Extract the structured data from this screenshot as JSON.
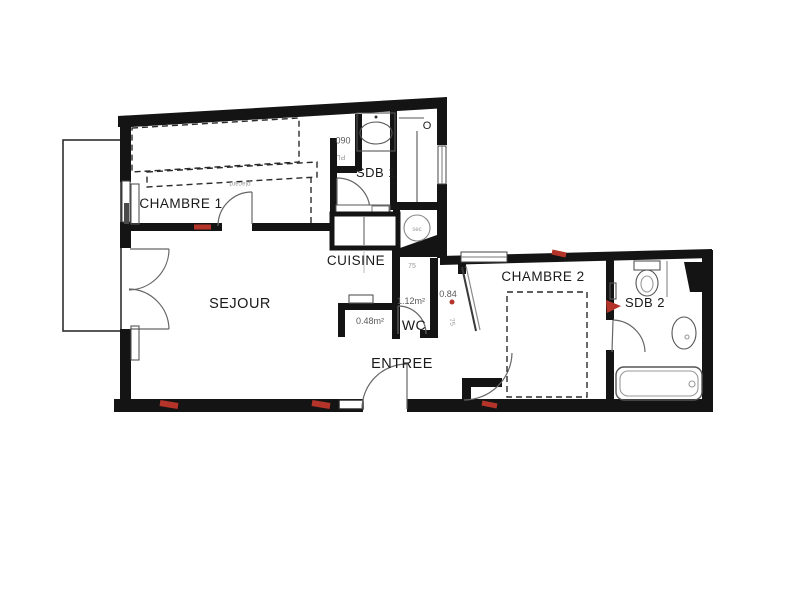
{
  "meta": {
    "type": "apartment-floor-plan"
  },
  "rooms": {
    "chambre1": "CHAMBRE 1",
    "sejour": "SEJOUR",
    "cuisine": "CUISINE",
    "sdb1": "SDB 1",
    "wc": "WC",
    "entree": "ENTREE",
    "chambre2": "CHAMBRE 2",
    "sdb2": "SDB 2"
  },
  "dimensions": {
    "placard_width": "060",
    "alcove_area": "0.48m²",
    "wc_area": "1.12m²",
    "door_width": "0.84",
    "corridor_width": "75",
    "corridor_width_2": "75"
  },
  "annotations": {
    "window_mark": "O",
    "placard_abbr": "PL",
    "appliance_label": "sec",
    "rotated_note": "placard"
  },
  "colors": {
    "wall": "#141414",
    "accent_red": "#b5342a"
  }
}
